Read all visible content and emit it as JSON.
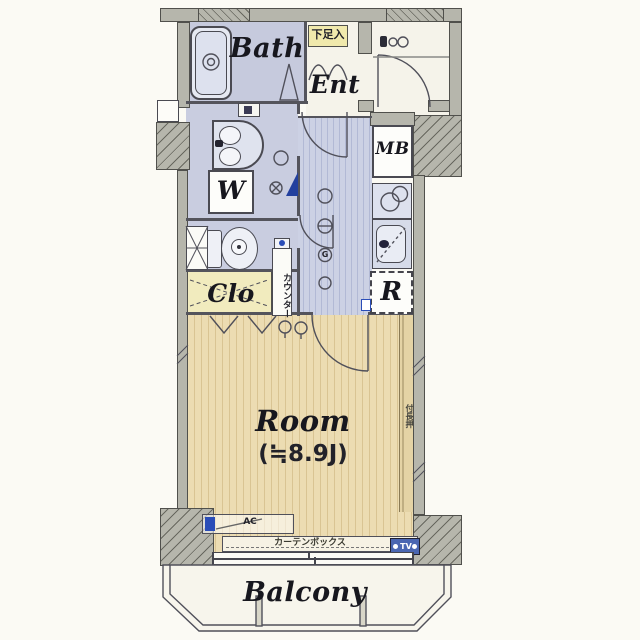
{
  "plan": {
    "type": "japanese-apartment-floorplan",
    "labels": {
      "bath": "Bath",
      "ent": "Ent",
      "shoe_box": "下足入",
      "meter_box": "MB",
      "washer": "W",
      "closet": "Clo",
      "counter": "カウンター",
      "fridge": "R",
      "gas_outlet": "G",
      "room": "Room",
      "room_size": "(≒8.9J)",
      "nageshi": "付長押",
      "ac": "AC",
      "curtain_box": "カーテンボックス",
      "tv": "TV",
      "balcony": "Balcony"
    },
    "colors": {
      "paper": "#fbfaf4",
      "wall": "#b6b6ac",
      "wall_outline": "#50504c",
      "wet_area_floor": "#c9cde0",
      "kitchen_stripe": "#b2b9d5",
      "room_floor": "#ecdcb2",
      "room_stripe": "#d9c493",
      "closet_floor": "#f1ebbe",
      "shoe_box_bg": "#f0e9ac",
      "accent_blue": "#2a4db8"
    }
  }
}
